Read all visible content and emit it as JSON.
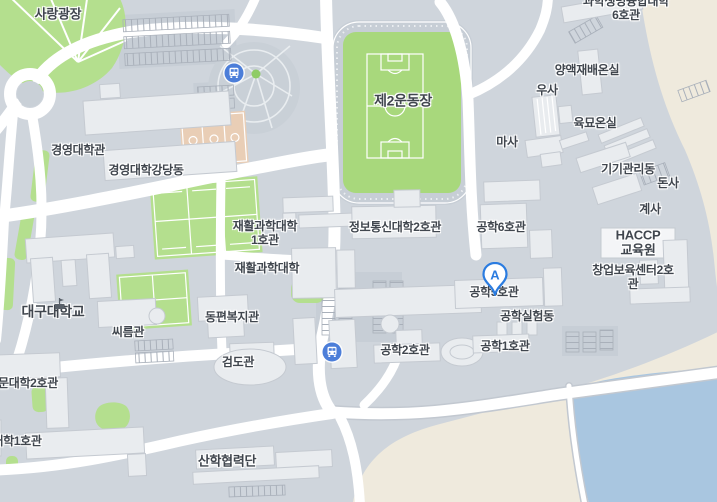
{
  "map": {
    "title": "대구대학교 캠퍼스 지도",
    "colors": {
      "map-bg": "#cfd5dc",
      "road": "#ffffff",
      "road-casing": "#c2c8d0",
      "building": "#e9ecef",
      "building-light": "#f4f5f7",
      "building-stroke": "#c5cad1",
      "green": "#b4df8e",
      "field-green": "#a8d87c",
      "court-tan": "#e9ceb6",
      "sand": "#efeadd",
      "water": "#a9c6e0",
      "label-text": "#40464e",
      "bus-blue": "#4c7ed9",
      "pin-blue": "#2b7ce0",
      "parking-line": "#a9b0ba",
      "plaza-dark": "#c7ced6"
    },
    "labels": [
      {
        "id": "sarang-plaza",
        "text": "사랑광장"
      },
      {
        "id": "sci-life-univ-6",
        "text": "과학생명융합대학6호관"
      },
      {
        "id": "greenhouse-yangaek",
        "text": "양액재배온실"
      },
      {
        "id": "usa-barn",
        "text": "우사"
      },
      {
        "id": "greenhouse-yukmyo",
        "text": "육묘온실"
      },
      {
        "id": "masa-stable",
        "text": "마사"
      },
      {
        "id": "equip-mgmt",
        "text": "기기관리동"
      },
      {
        "id": "donsa-pigpen",
        "text": "돈사"
      },
      {
        "id": "gyesa-coop",
        "text": "계사"
      },
      {
        "id": "business-college-hall",
        "text": "경영대학관"
      },
      {
        "id": "business-college-auditorium",
        "text": "경영대학강당동"
      },
      {
        "id": "field-2",
        "text": "제2운동장"
      },
      {
        "id": "rehab-science-1",
        "text": "재활과학대학\n1호관"
      },
      {
        "id": "rehab-science",
        "text": "재활과학대학"
      },
      {
        "id": "info-comm-2",
        "text": "정보통신대학2호관"
      },
      {
        "id": "eng-6",
        "text": "공학6호관"
      },
      {
        "id": "haccp-center",
        "text": "HACCP\n교육원"
      },
      {
        "id": "startup-incubator-2",
        "text": "창업보육센터2호관"
      },
      {
        "id": "eng-5",
        "text": "공학5호관"
      },
      {
        "id": "eng-lab",
        "text": "공학실험동"
      },
      {
        "id": "daegu-university",
        "text": "대구대학교"
      },
      {
        "id": "ssireum-hall",
        "text": "씨름관"
      },
      {
        "id": "dongpyeon-welfare",
        "text": "동편복지관"
      },
      {
        "id": "geomdo-hall",
        "text": "검도관"
      },
      {
        "id": "eng-2",
        "text": "공학2호관"
      },
      {
        "id": "eng-1",
        "text": "공학1호관"
      },
      {
        "id": "mun-college-2",
        "text": "문대학2호관"
      },
      {
        "id": "college-1",
        "text": "대학1호관"
      },
      {
        "id": "sanhak-cooperation",
        "text": "산학협력단"
      }
    ],
    "marker": {
      "label": "A",
      "name": "location-pin-a-icon"
    },
    "bus_stops": [
      {
        "name": "bus-stop-icon"
      },
      {
        "name": "bus-stop-icon"
      }
    ],
    "school_icon": {
      "name": "school-flag-icon"
    }
  }
}
